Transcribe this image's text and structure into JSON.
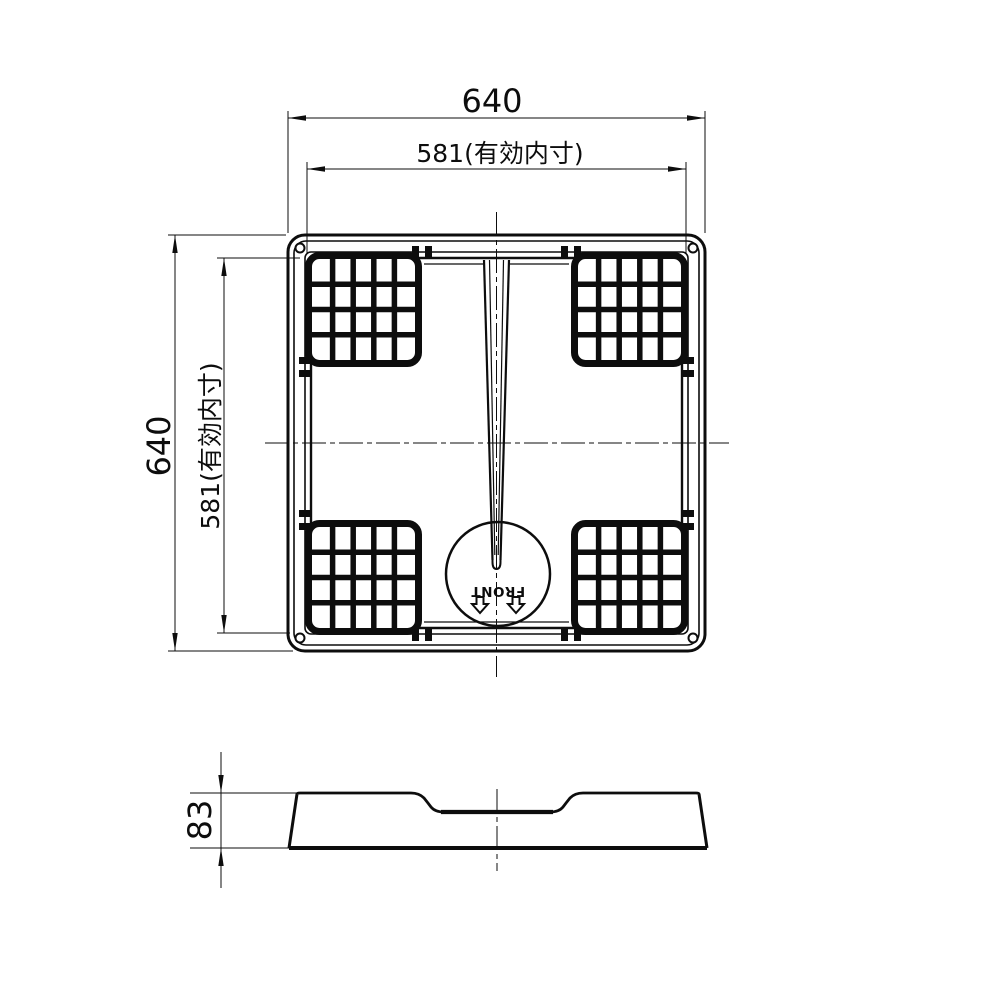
{
  "drawing": {
    "type": "technical-drawing",
    "views": {
      "plan": {
        "dim_width_outer": "640",
        "dim_width_inner": "581(有効内寸)",
        "dim_height_outer": "640",
        "dim_height_inner": "581(有効内寸)",
        "front_label": "FRONT"
      },
      "side": {
        "dim_height": "83"
      }
    },
    "colors": {
      "line": "#0d0d0d",
      "background": "#ffffff"
    }
  }
}
